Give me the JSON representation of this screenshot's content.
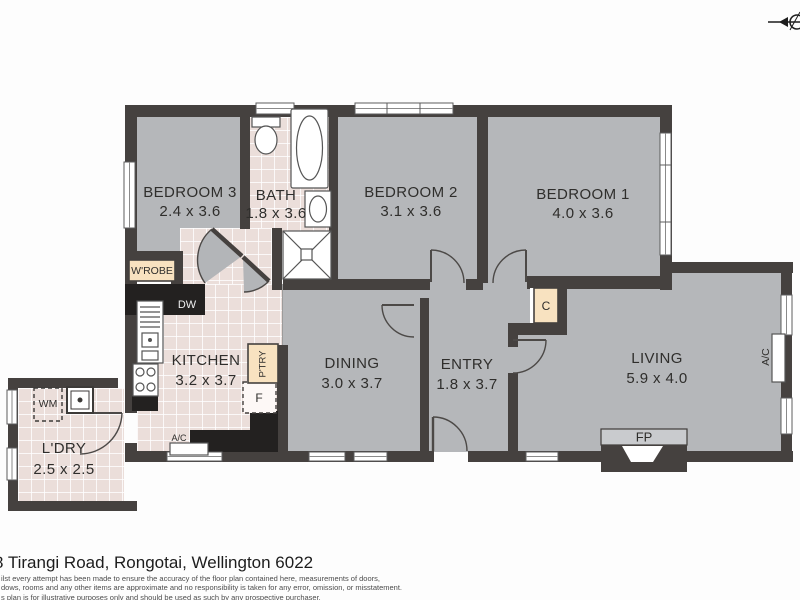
{
  "plan": {
    "type": "residential-floor-plan",
    "compass": "north-arrow-top-right"
  },
  "rooms": {
    "bedroom3": {
      "name": "BEDROOM 3",
      "dims": "2.4 x 3.6"
    },
    "bath": {
      "name": "BATH",
      "dims": "1.8 x 3.6"
    },
    "bedroom2": {
      "name": "BEDROOM 2",
      "dims": "3.1 x 3.6"
    },
    "bedroom1": {
      "name": "BEDROOM 1",
      "dims": "4.0 x 3.6"
    },
    "kitchen": {
      "name": "KITCHEN",
      "dims": "3.2 x 3.7"
    },
    "dining": {
      "name": "DINING",
      "dims": "3.0 x 3.7"
    },
    "entry": {
      "name": "ENTRY",
      "dims": "1.8 x 3.7"
    },
    "living": {
      "name": "LIVING",
      "dims": "5.9 x 4.0"
    },
    "laundry": {
      "name": "L'DRY",
      "dims": "2.5 x 2.5"
    }
  },
  "fixtures": {
    "wardrobe": "W'ROBE",
    "dishwasher": "DW",
    "pantry": "P'TRY",
    "fridge": "F",
    "cupboard": "C",
    "ac_kitchen": "A/C",
    "ac_living": "A/C",
    "washing_machine": "WM",
    "fireplace": "FP"
  },
  "footer": {
    "address": "8 Tirangi Road, Rongotai, Wellington 6022",
    "disclaimer_line1": "ilst every attempt has been made to ensure the accuracy of the floor plan contained here, measurements of doors,",
    "disclaimer_line2": "dows, rooms and any other items are approximate and no responsibility is taken for any error, omission, or misstatement.",
    "disclaimer_line3": "s plan is for illustrative purposes only and should be used as such by any prospective purchaser."
  },
  "colors": {
    "wall": "#45413f",
    "counter": "#232120",
    "floor_gray": "#b5b7ba",
    "floor_tile": "#ebdeda",
    "tan": "#f8e2c0",
    "fp_band": "#c9cbce"
  }
}
